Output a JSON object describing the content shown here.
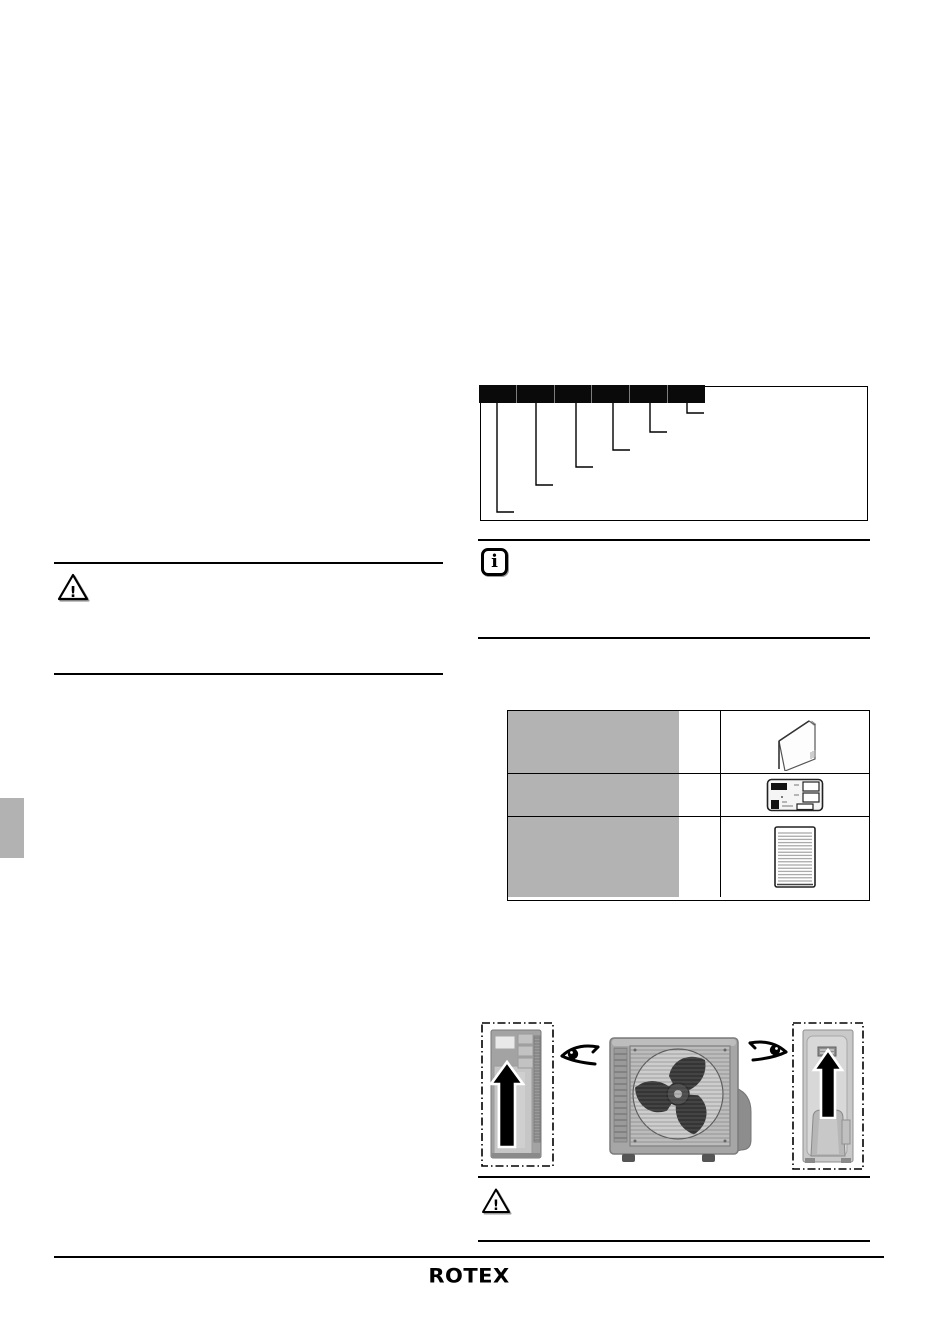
{
  "page": {
    "kind": "scanned-installation-manual-page",
    "background": "#ffffff"
  },
  "symbols": {
    "info_glyph": "i",
    "warning_glyph": "!"
  },
  "footer": {
    "logo_text": "ROTEX"
  },
  "model_code_figure": {
    "segments": [
      "",
      "",
      "",
      "",
      "",
      ""
    ],
    "segment_fill": "#0a0a0a",
    "callout_count": 6
  },
  "delivery_table": {
    "rows": [
      {
        "label": "",
        "quantity": "",
        "item_icon": "operation-manual-icon"
      },
      {
        "label": "",
        "quantity": "",
        "item_icon": "rating-plate-icon"
      },
      {
        "label": "",
        "quantity": "",
        "item_icon": "document-sheet-icon"
      }
    ],
    "label_cell_color": "#b3b3b3"
  },
  "unit_figure": {
    "views": [
      "left-side-view",
      "front-view",
      "right-side-view"
    ],
    "arrow_color": "#000000",
    "view_direction_icon": "eye-icon"
  },
  "colors": {
    "ink": "#000000",
    "edge_tab": "#b2b2b2",
    "unit_body_gray": "#a6a6a6"
  }
}
